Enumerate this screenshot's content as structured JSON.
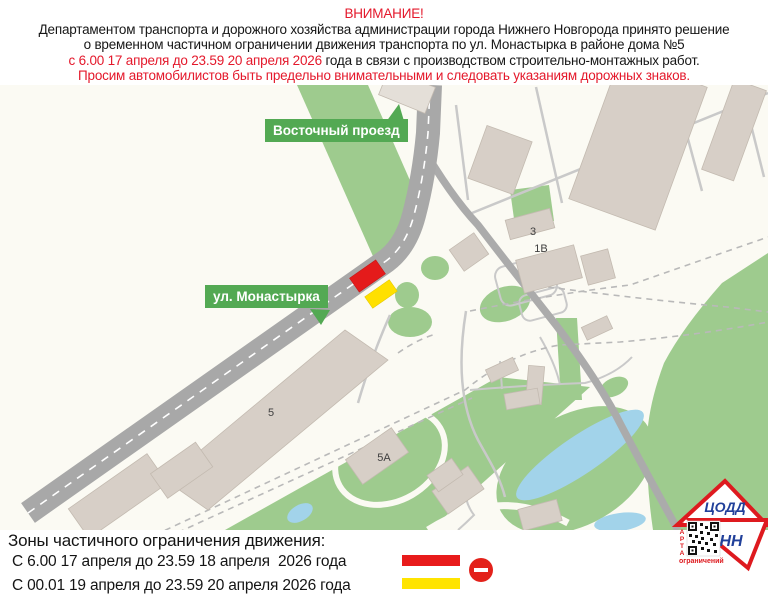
{
  "header": {
    "attention": "ВНИМАНИЕ!",
    "line1": "Департаментом транспорта и дорожного хозяйства администрации города Нижнего Новгорода принято решение",
    "line2": "о временном частичном ограничении движения транспорта по ул. Монастырка в районе дома №5",
    "line3_red": "с 6.00 17 апреля до 23.59 20 апреля 2026",
    "line3_black": " года в связи с производством строительно-монтажных работ.",
    "line4": "Просим автомобилистов быть предельно внимательными и следовать указаниям дорожных знаков."
  },
  "map": {
    "street_labels": {
      "vostochny": "Восточный проезд",
      "monastyrka": "ул. Монастырка"
    },
    "building_labels": {
      "b3": "3",
      "b1v": "1В",
      "b5": "5",
      "b5a": "5А"
    },
    "colors": {
      "restriction_red": "#e41b1b",
      "restriction_yellow": "#ffe000",
      "street_label_green": "#53a953"
    }
  },
  "legend": {
    "title": "Зоны частичного ограничения движения:",
    "rows": [
      {
        "label": "С 6.00 17 апреля до 23.59 18 апреля  2026 года",
        "bar_color": "#e81b1b",
        "icon": "no-entry-sign"
      },
      {
        "label": "С 00.01 19 апреля до 23.59 20 апреля 2026 года",
        "bar_color": "#ffe400"
      }
    ]
  },
  "logo": {
    "org": "ЦОДД",
    "city": "НН",
    "vertical_word_letters": [
      "К",
      "А",
      "Р",
      "Т",
      "А"
    ],
    "caption": "ограничений"
  }
}
